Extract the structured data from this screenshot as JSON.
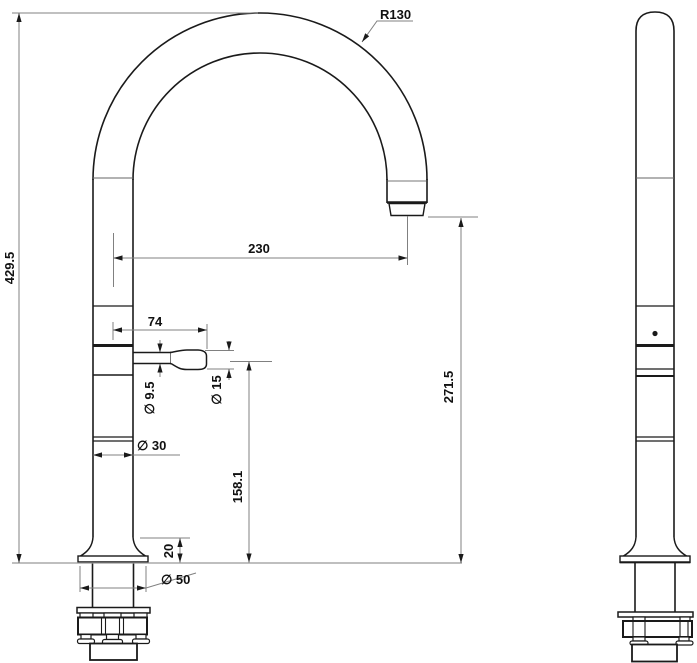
{
  "drawing": {
    "type": "technical-dimension-drawing",
    "views": {
      "front_view": "gooseneck faucet front elevation",
      "side_view": "gooseneck faucet side elevation"
    },
    "dimensions": {
      "spout_radius": "R130",
      "spout_reach": "230",
      "total_height": "429.5",
      "outlet_height": "271.5",
      "handle_length": "74",
      "handle_height": "158.1",
      "base_height": "20",
      "handle_stem_diameter": "∅ 9.5",
      "handle_knob_diameter": "∅ 15",
      "body_diameter": "∅ 30",
      "base_diameter": "∅ 50"
    },
    "colors": {
      "object_line": "#1a1a1a",
      "dimension_line": "#808080",
      "background": "#ffffff"
    }
  }
}
